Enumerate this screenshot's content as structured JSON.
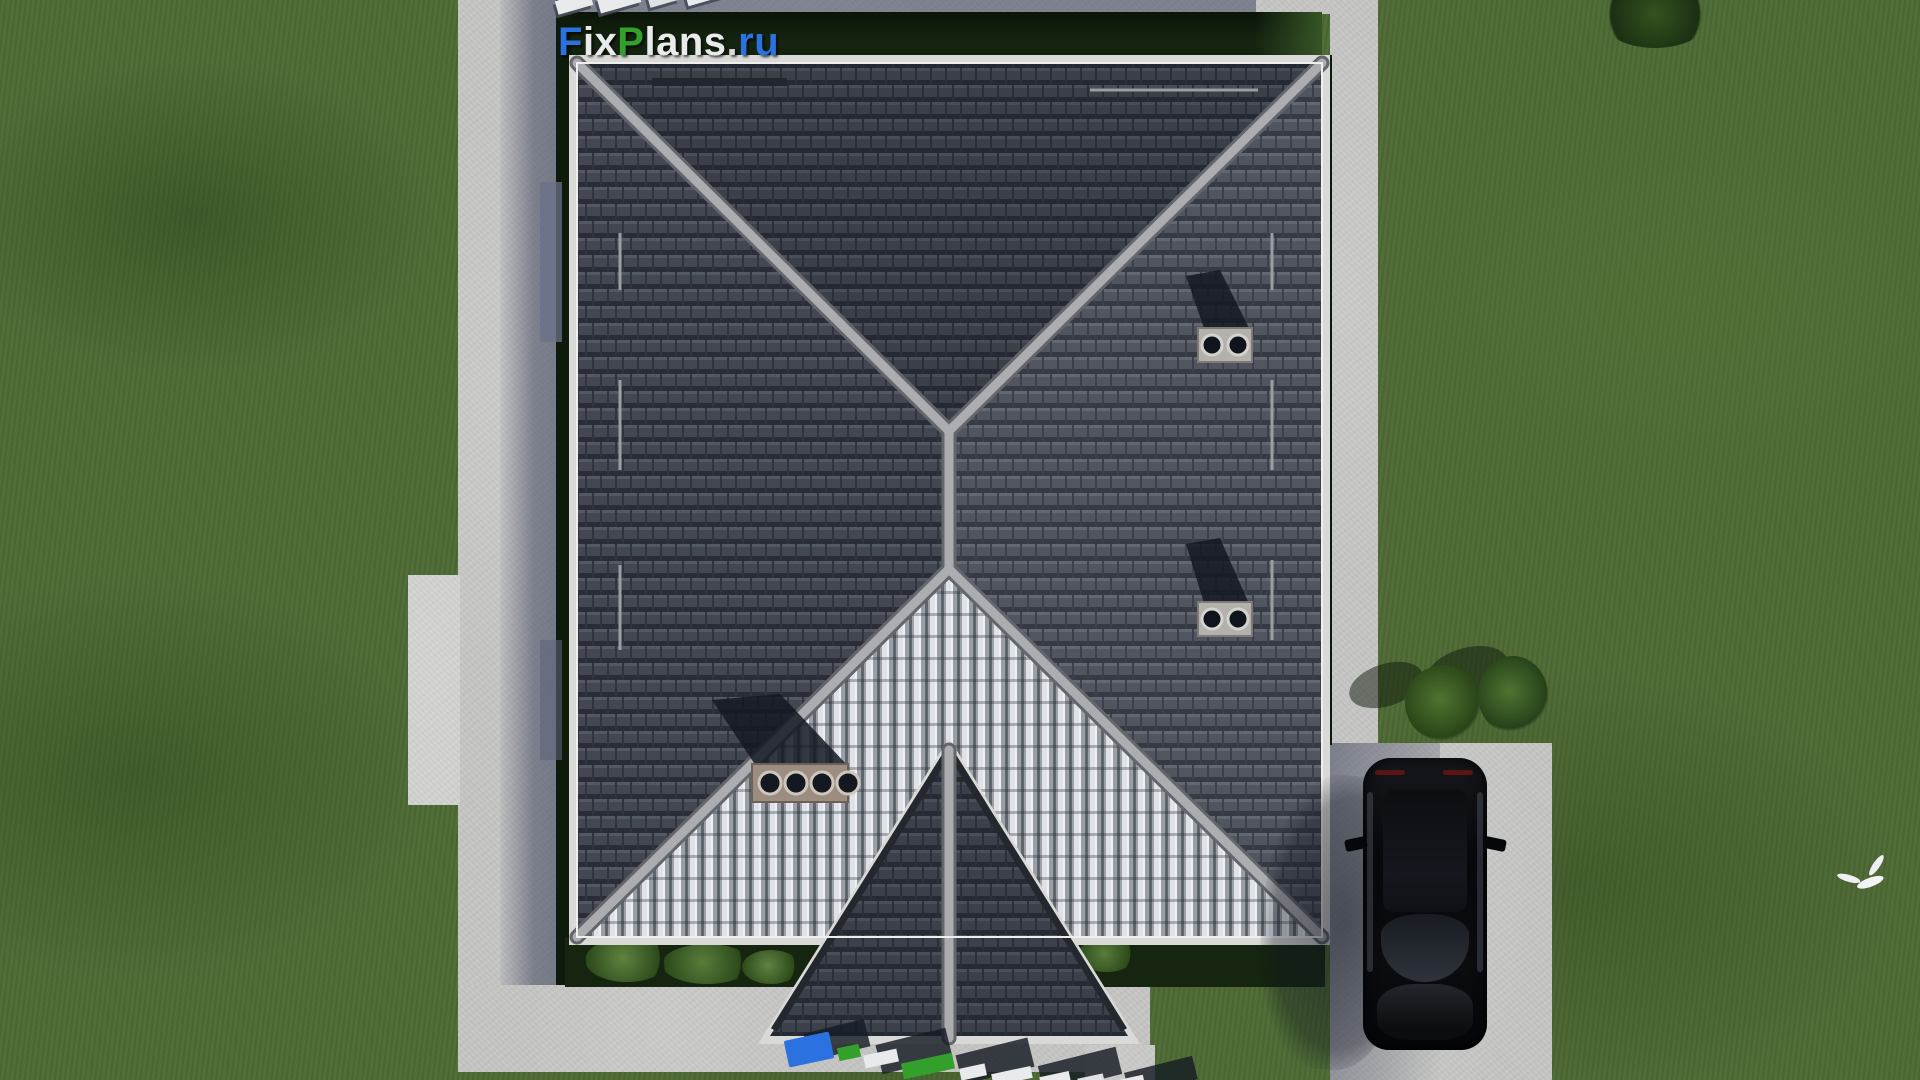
{
  "watermark": {
    "text": "FixPlans.ru",
    "segments": [
      {
        "text": "F",
        "color": "#2b72e0"
      },
      {
        "text": "ix",
        "color": "#e9eaec"
      },
      {
        "text": "P",
        "color": "#33a02c"
      },
      {
        "text": "lans",
        "color": "#e9eaec"
      },
      {
        "text": ".",
        "color": "#d9dadb"
      },
      {
        "text": "ru",
        "color": "#2b72e0"
      }
    ]
  },
  "colors": {
    "grass": "#4e6a34",
    "grass_shadow": "#16270e",
    "concrete": "#c8c8c6",
    "concrete_shadow": "#38405a",
    "roof_tile_dark": "#4a4f59",
    "roof_tile_silver": "#9aa0a6",
    "ridge_cap": "#abadb0",
    "eave_white": "#d9d9d7",
    "brand_blue": "#2b72e0",
    "brand_green": "#33a02c",
    "logo_white": "#e9eaec",
    "car_body": "#0b0d10",
    "taillight_red": "#5a1414"
  },
  "entities": [
    "hip-roof-house",
    "driveway",
    "garden-path",
    "black-car",
    "white-bird",
    "roof-chimneys",
    "garden-bushes",
    "corner-tree",
    "ground-3d-logo"
  ]
}
